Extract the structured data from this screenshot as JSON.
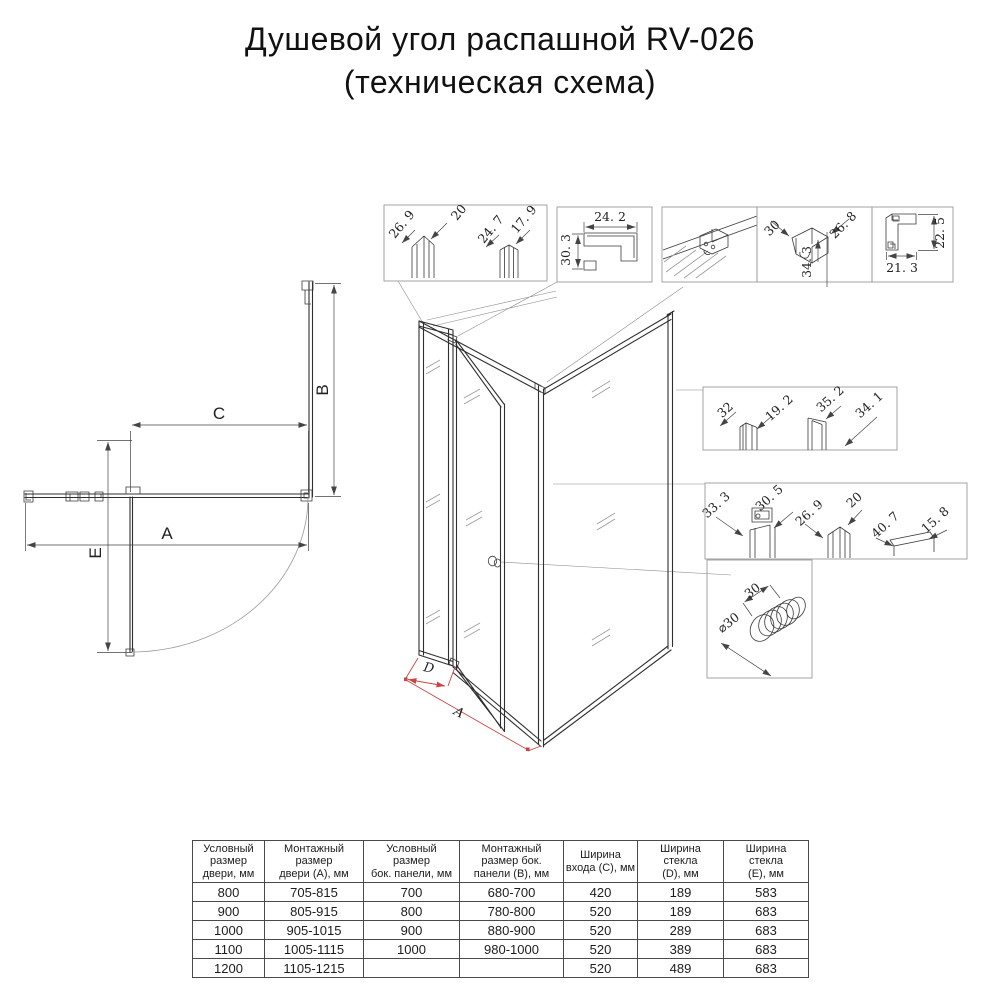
{
  "title": {
    "line1": "Душевой угол распашной RV-026",
    "line2": "(техническая схема)"
  },
  "plan_view": {
    "dim_b": "B",
    "dim_c": "C",
    "dim_a": "A",
    "dim_e": "E"
  },
  "iso_view": {
    "dim_d": "D",
    "dim_a": "A"
  },
  "detail_boxes": {
    "door_profiles": {
      "dims": [
        "26. 9",
        "20",
        "24. 7",
        "17. 9"
      ]
    },
    "corner_profile": {
      "dims": [
        "24. 2",
        "30. 3"
      ]
    },
    "wall_bracket": {
      "dims": []
    },
    "top_bracket": {
      "dims": [
        "30",
        "26. 8",
        "34. 3"
      ]
    },
    "l_profile": {
      "dims": [
        "22. 5",
        "21. 3"
      ]
    },
    "side_seals": {
      "dims": [
        "32",
        "19. 2",
        "35. 2",
        "34. 1"
      ]
    },
    "bottom_profiles": {
      "dims": [
        "33. 3",
        "30. 5",
        "26. 9",
        "20",
        "40. 7",
        "15. 8"
      ]
    },
    "knob": {
      "dims": [
        "30",
        "⌀30"
      ]
    }
  },
  "table": {
    "headers": [
      "Условный\nразмер\nдвери, мм",
      "Монтажный\nразмер\nдвери (А), мм",
      "Условный\nразмер\nбок. панели, мм",
      "Монтажный\nразмер бок.\nпанели (В), мм",
      "Ширина\nвхода (С), мм",
      "Ширина\nстекла\n(D), мм",
      "Ширина\nстекла\n(Е), мм"
    ],
    "rows": [
      [
        "800",
        "705-815",
        "700",
        "680-700",
        "420",
        "189",
        "583"
      ],
      [
        "900",
        "805-915",
        "800",
        "780-800",
        "520",
        "189",
        "683"
      ],
      [
        "1000",
        "905-1015",
        "900",
        "880-900",
        "520",
        "289",
        "683"
      ],
      [
        "1100",
        "1005-1115",
        "1000",
        "980-1000",
        "520",
        "389",
        "683"
      ],
      [
        "1200",
        "1105-1215",
        "",
        "",
        "520",
        "489",
        "683"
      ]
    ]
  }
}
